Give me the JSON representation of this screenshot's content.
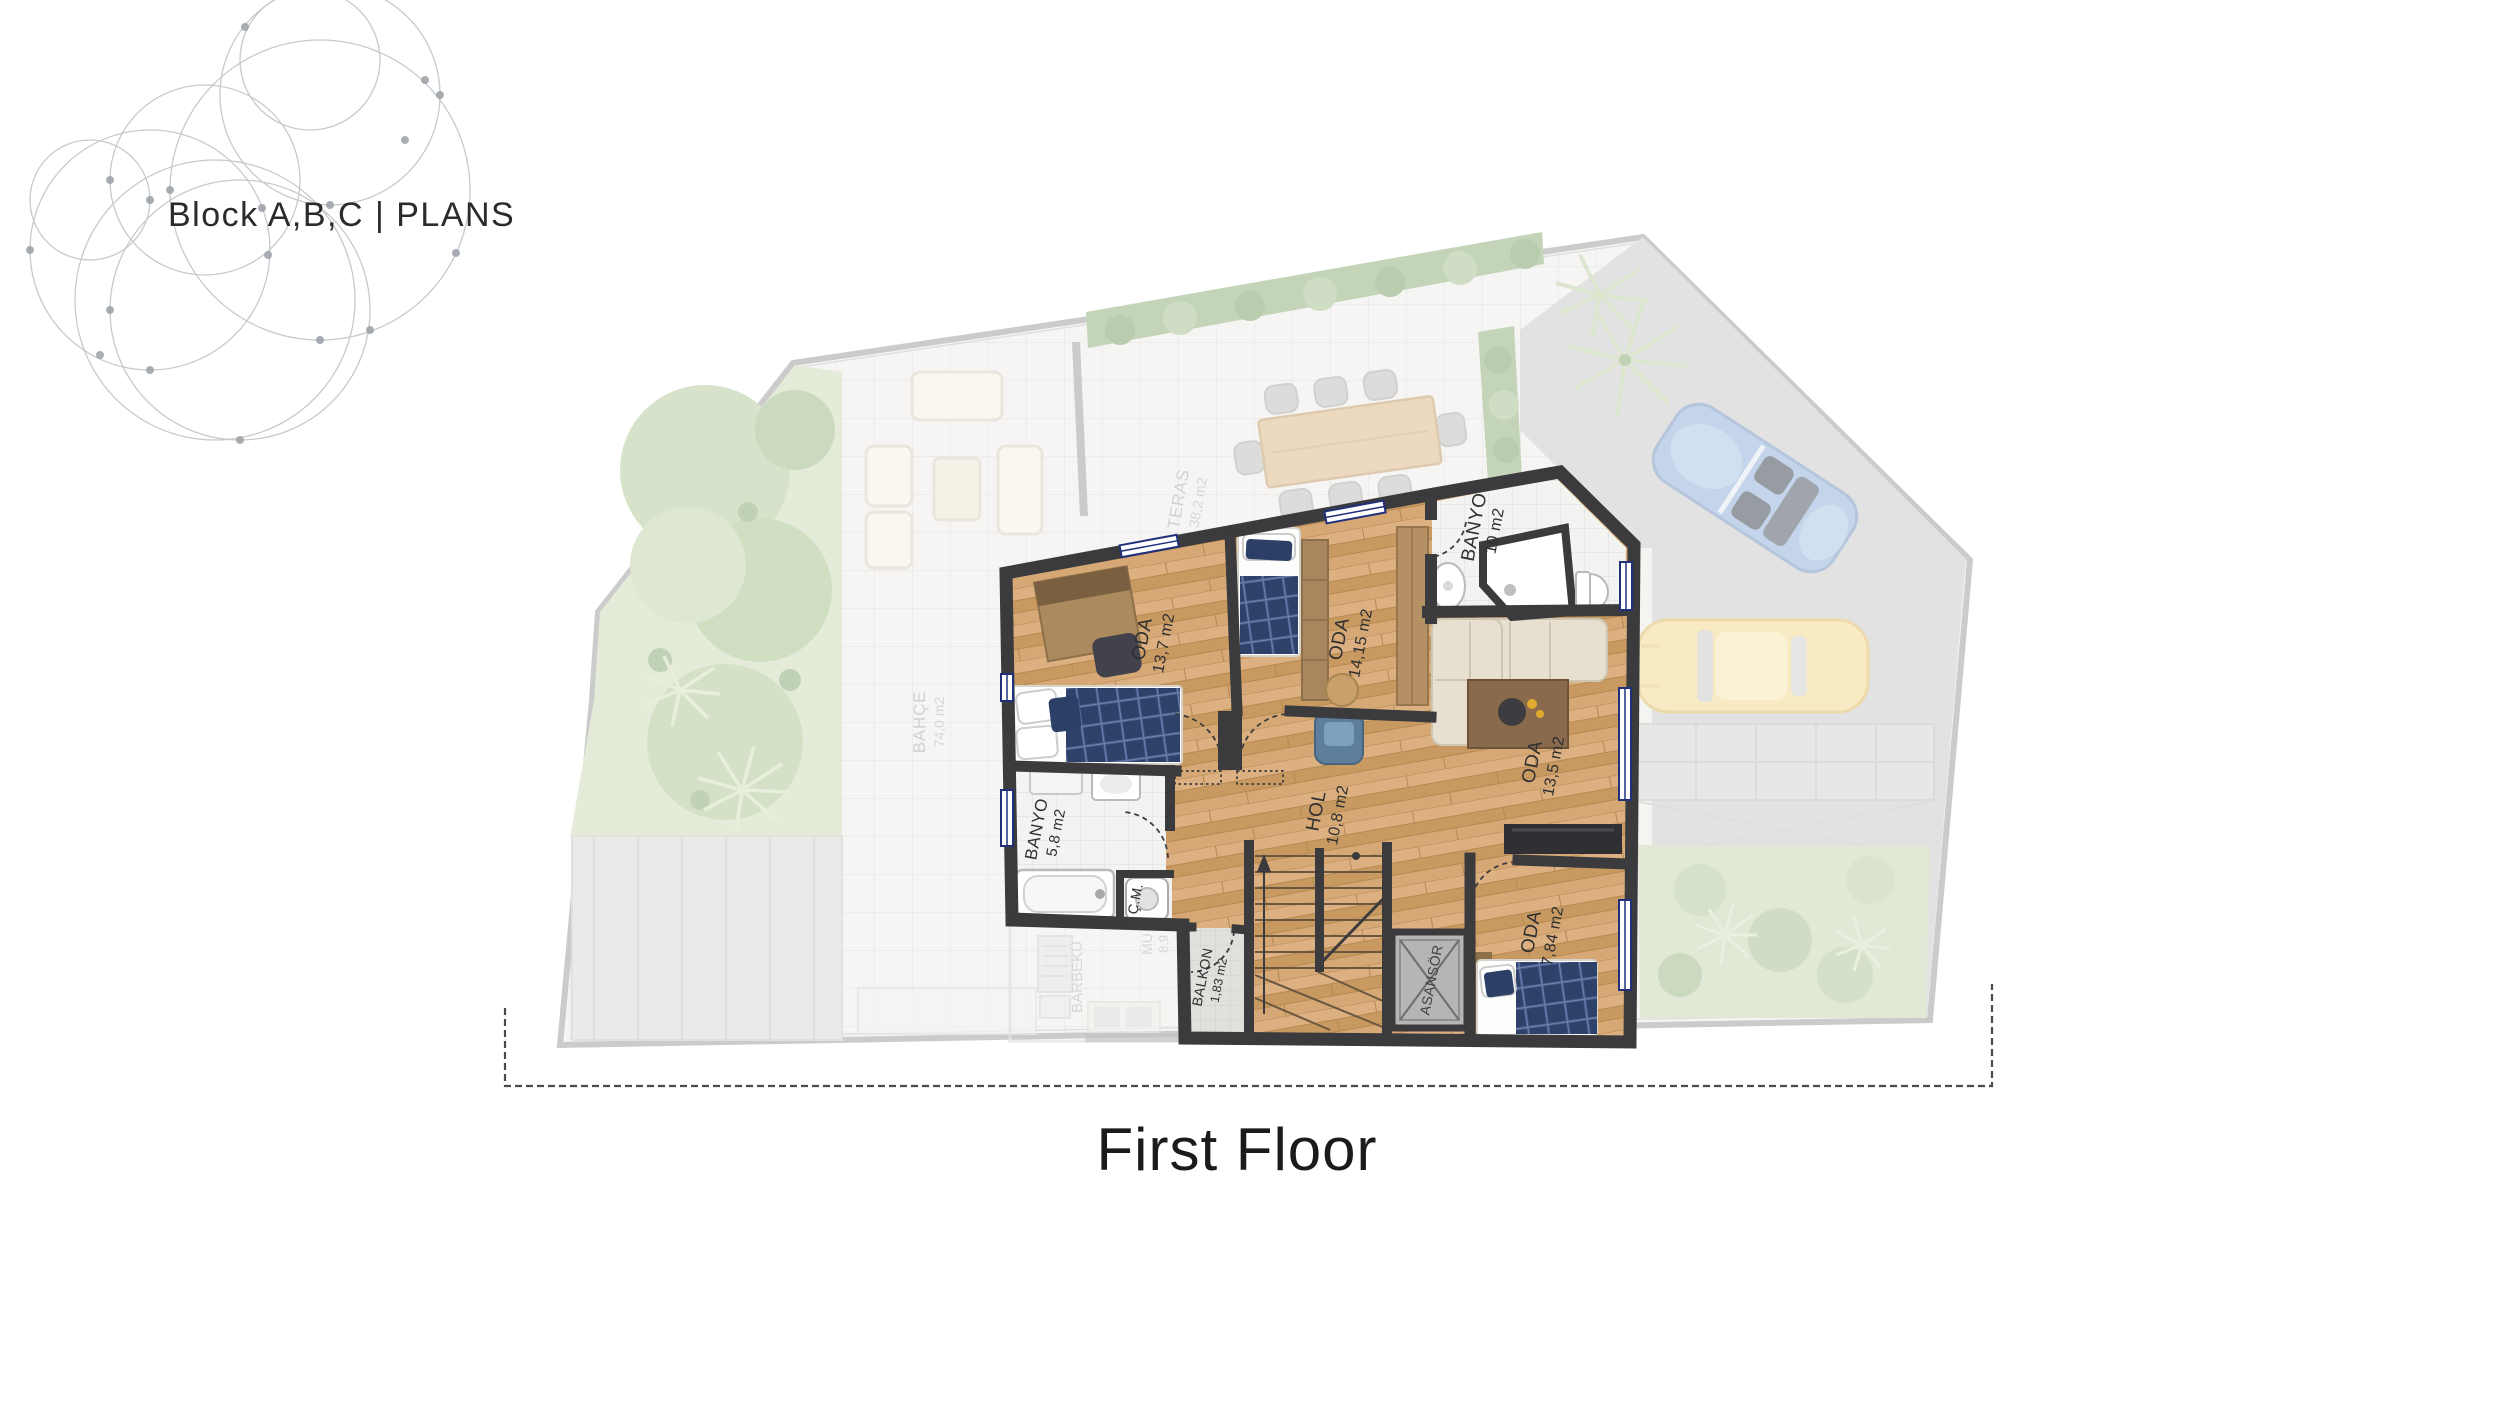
{
  "header": {
    "title": "Block A,B,C | PLANS"
  },
  "footer": {
    "floor_label": "First Floor"
  },
  "plan": {
    "unit_rooms": [
      {
        "name": "ODA",
        "area": "13,7 m2"
      },
      {
        "name": "ODA",
        "area": "14,15 m2"
      },
      {
        "name": "BANYO",
        "area": "10 m2"
      },
      {
        "name": "ODA",
        "area": "13,5 m2"
      },
      {
        "name": "HOL",
        "area": "10,8 m2"
      },
      {
        "name": "BANYO",
        "area": "5,8 m2"
      },
      {
        "name": "Ç.M.",
        "area": ""
      },
      {
        "name": "BALKON",
        "area": "1,83 m2"
      },
      {
        "name": "ASANSÖR",
        "area": ""
      },
      {
        "name": "ODA",
        "area": "7,84 m2"
      }
    ],
    "site_labels": [
      {
        "name": "TERAS",
        "area": "38,2 m2"
      },
      {
        "name": "BAHÇE",
        "area": "74,0 m2"
      },
      {
        "name": "BARBEKÜ",
        "area": ""
      },
      {
        "name": "MU",
        "area": "8,9"
      }
    ]
  },
  "colors": {
    "wall": "#3b3b3d",
    "wood": "#d2a470",
    "bed_navy": "#2e4168",
    "car_blue": "#8fb0d9",
    "car_yellow": "#f3da90",
    "garden_green": "#b9cfa2",
    "driveway_gray": "#c8c8c8"
  }
}
